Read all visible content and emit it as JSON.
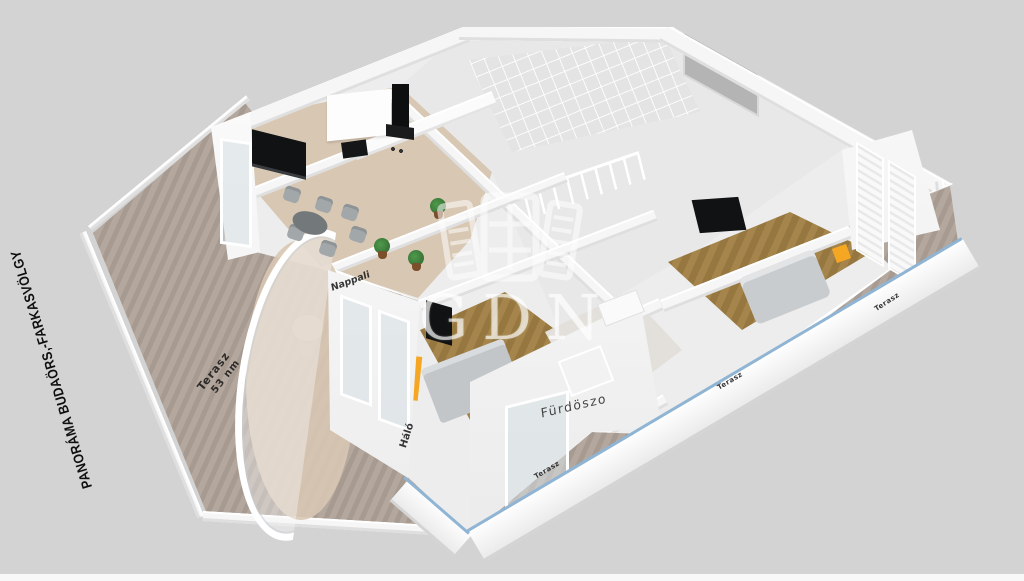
{
  "title": {
    "text": "PANORÁMA BUDAÖRS,-FARKASVÖLGY"
  },
  "watermark": {
    "text": "GDN",
    "icon": "gdn-shutter-logo",
    "color": "rgba(255,255,255,0.62)"
  },
  "floorplan": {
    "rooms": {
      "terasz_main": {
        "name": "Terasz",
        "area": "53 nm"
      },
      "nappali": {
        "name": "Nappali"
      },
      "halo": {
        "name": "Háló"
      },
      "furdoszoba": {
        "name": "Fürdöszo"
      },
      "terasz_bottom": {
        "name": "Terasz"
      },
      "terasz_mid": {
        "name": "Terasz"
      },
      "terasz_right": {
        "name": "Terasz"
      }
    },
    "colors": {
      "background": "#d3d3d3",
      "terrace_tile": "#a79a90",
      "terrace_tile_light": "#b4a89e",
      "wall_white": "#f6f6f6",
      "living_floor": "#d8c7b2",
      "wood_floor": "#9c7c50",
      "accent_orange": "#f5a623",
      "railing_glass": "#8fb4d4",
      "furniture_gray": "#a2a7aa",
      "tv_black": "#101214",
      "plant_green": "#3e7d3c"
    }
  }
}
